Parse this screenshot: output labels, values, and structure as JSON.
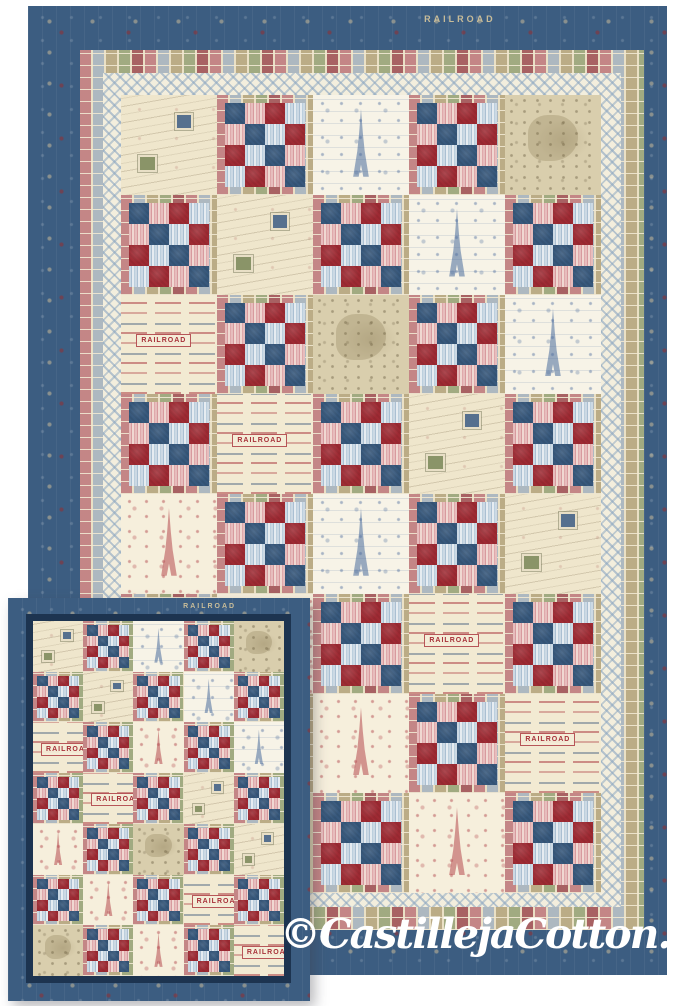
{
  "photo": {
    "subject": "Travel-theme Irish chain quilts in two sizes",
    "background_color": "#ffffff"
  },
  "watermark": {
    "text": "©CastillejaCotton.com",
    "color": "#ffffff"
  },
  "palette": {
    "border_navy": "#3c5d81",
    "frame_navy": "#1d3450",
    "chain_red": "#9e2a33",
    "chain_blue": "#37587c",
    "chain_pink": "#dfa9ab",
    "chain_pale_blue": "#bccfdd",
    "stamp_tan": "#c7b28d",
    "lattice_cream": "#f3eedd",
    "lattice_line": "#8aa5c0",
    "toile_blue": "#48689a",
    "toile_red": "#b2464c",
    "map_tan": "#d9cead",
    "letter_cream": "#efe6cc"
  },
  "fabric_names": {
    "chain": "patchwork chain block with stamp-collage frame",
    "letters": "vintage postcards and handwriting print",
    "paris_blue": "Paris landmarks toile in blue",
    "map": "antique map print in tan",
    "ads": "vintage travel advertisement print",
    "paris_red": "Paris landmarks toile in red"
  },
  "chain_block": {
    "frame": "stamp-collage",
    "cells": [
      [
        "blue",
        "pink",
        "red",
        "pale"
      ],
      [
        "pink",
        "blue",
        "pale",
        "red"
      ],
      [
        "red",
        "pale",
        "blue",
        "pink"
      ],
      [
        "pale",
        "red",
        "pink",
        "blue"
      ]
    ]
  },
  "ads_text": "RAILROAD",
  "large_quilt": {
    "name": "large quilt",
    "borders": [
      "navy travel print",
      "postage stamp collage",
      "cream lattice"
    ],
    "border_text": [
      "RAILROAD",
      "RAILROAD"
    ],
    "grid": {
      "cols": 5,
      "rows": 8
    },
    "layout": [
      [
        "letters",
        "chain",
        "paris_blue",
        "chain",
        "map"
      ],
      [
        "chain",
        "letters",
        "chain",
        "paris_blue",
        "chain"
      ],
      [
        "ads",
        "chain",
        "map",
        "chain",
        "paris_blue"
      ],
      [
        "chain",
        "ads",
        "chain",
        "letters",
        "chain"
      ],
      [
        "paris_red",
        "chain",
        "paris_blue",
        "chain",
        "letters"
      ],
      [
        "chain",
        "paris_red",
        "chain",
        "ads",
        "chain"
      ],
      [
        "map",
        "chain",
        "paris_red",
        "chain",
        "ads"
      ],
      [
        "chain",
        "map",
        "chain",
        "paris_red",
        "chain"
      ]
    ]
  },
  "small_quilt": {
    "name": "small quilt",
    "borders": [
      "navy travel print",
      "navy frame"
    ],
    "border_text": [
      "RAILROAD"
    ],
    "grid": {
      "cols": 5,
      "rows": 7
    },
    "layout": [
      [
        "letters",
        "chain",
        "paris_blue",
        "chain",
        "map"
      ],
      [
        "chain",
        "letters",
        "chain",
        "paris_blue",
        "chain"
      ],
      [
        "ads",
        "chain",
        "paris_red",
        "chain",
        "paris_blue"
      ],
      [
        "chain",
        "ads",
        "chain",
        "letters",
        "chain"
      ],
      [
        "paris_red",
        "chain",
        "map",
        "chain",
        "letters"
      ],
      [
        "chain",
        "paris_red",
        "chain",
        "ads",
        "chain"
      ],
      [
        "map",
        "chain",
        "paris_red",
        "chain",
        "ads"
      ]
    ]
  }
}
